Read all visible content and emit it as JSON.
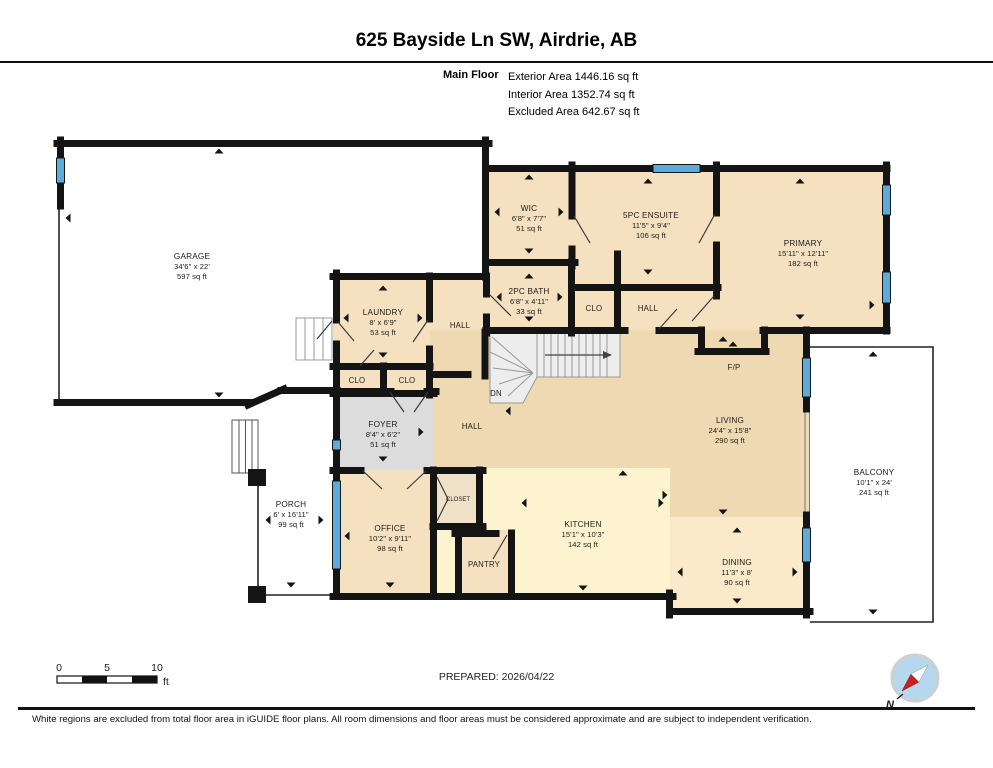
{
  "header": {
    "title": "625 Bayside Ln SW, Airdrie, AB",
    "floor_label": "Main Floor",
    "exterior": "Exterior Area 1446.16 sq ft",
    "interior": "Interior Area 1352.74 sq ft",
    "excluded": "Excluded Area 642.67 sq ft"
  },
  "rooms": {
    "garage": {
      "name": "GARAGE",
      "dims": "34'6\" x 22'",
      "area": "597 sq ft"
    },
    "wic": {
      "name": "WIC",
      "dims": "6'8\" x 7'7\"",
      "area": "51 sq ft"
    },
    "ensuite": {
      "name": "5PC ENSUITE",
      "dims": "11'5\" x 9'4\"",
      "area": "106 sq ft"
    },
    "primary": {
      "name": "PRIMARY",
      "dims": "15'11\" x 12'11\"",
      "area": "182 sq ft"
    },
    "bath": {
      "name": "2PC BATH",
      "dims": "6'8\" x 4'11\"",
      "area": "33 sq ft"
    },
    "laundry": {
      "name": "LAUNDRY",
      "dims": "8' x 6'9\"",
      "area": "53 sq ft"
    },
    "foyer": {
      "name": "FOYER",
      "dims": "8'4\" x 6'2\"",
      "area": "51 sq ft"
    },
    "office": {
      "name": "OFFICE",
      "dims": "10'2\" x 9'11\"",
      "area": "98 sq ft"
    },
    "porch": {
      "name": "PORCH",
      "dims": "6' x 16'11\"",
      "area": "99 sq ft"
    },
    "kitchen": {
      "name": "KITCHEN",
      "dims": "15'1\" x 10'3\"",
      "area": "142 sq ft"
    },
    "living": {
      "name": "LIVING",
      "dims": "24'4\" x 15'8\"",
      "area": "290 sq ft"
    },
    "dining": {
      "name": "DINING",
      "dims": "11'3\" x 8'",
      "area": "90 sq ft"
    },
    "balcony": {
      "name": "BALCONY",
      "dims": "10'1\" x 24'",
      "area": "241 sq ft"
    }
  },
  "small": {
    "hall": "HALL",
    "clo": "CLO",
    "closet": "CLOSET",
    "pantry": "PANTRY",
    "fp": "F/P",
    "dn": "DN",
    "north": "N"
  },
  "scale": {
    "t0": "0",
    "t5": "5",
    "t10": "10",
    "unit": "ft"
  },
  "footer": {
    "prepared": "PREPARED: 2026/04/22",
    "disclaimer": "White regions are excluded from total floor area in iGUIDE floor plans. All room dimensions and floor areas must be considered approximate and are subject to independent verification."
  },
  "colors": {
    "wall": "#141414",
    "window_blue": "#5fabd7",
    "room_tan": "#f5e1c0",
    "living_tan": "#eed9b2",
    "kitchen_cream": "#fdf4cf",
    "dining_cream": "#faeac9",
    "foyer_gray": "#dcdcdc",
    "excluded_white": "#ffffff",
    "compass_blue": "#b5d8ef",
    "compass_red": "#cc1f1f"
  }
}
